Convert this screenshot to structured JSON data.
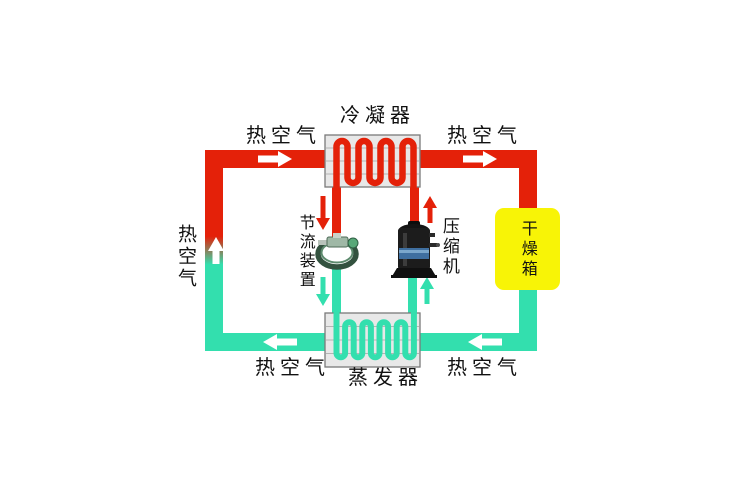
{
  "diagram": {
    "labels": {
      "condenser": "冷凝器",
      "evaporator": "蒸发器",
      "throttle_device": "节流装置",
      "compressor": "压缩机",
      "drying_box": "干燥箱",
      "hot_air_top_left": "热空气",
      "hot_air_top_right": "热空气",
      "hot_air_left": "热空气",
      "hot_air_bottom_left": "热空气",
      "hot_air_bottom_right": "热空气"
    },
    "colors": {
      "hot_pipe": "#e42109",
      "cold_pipe": "#33dfae",
      "drying_box_fill": "#f8f406",
      "heat_exchanger_fill": "#e8e8e8",
      "arrow_white": "#ffffff"
    }
  }
}
